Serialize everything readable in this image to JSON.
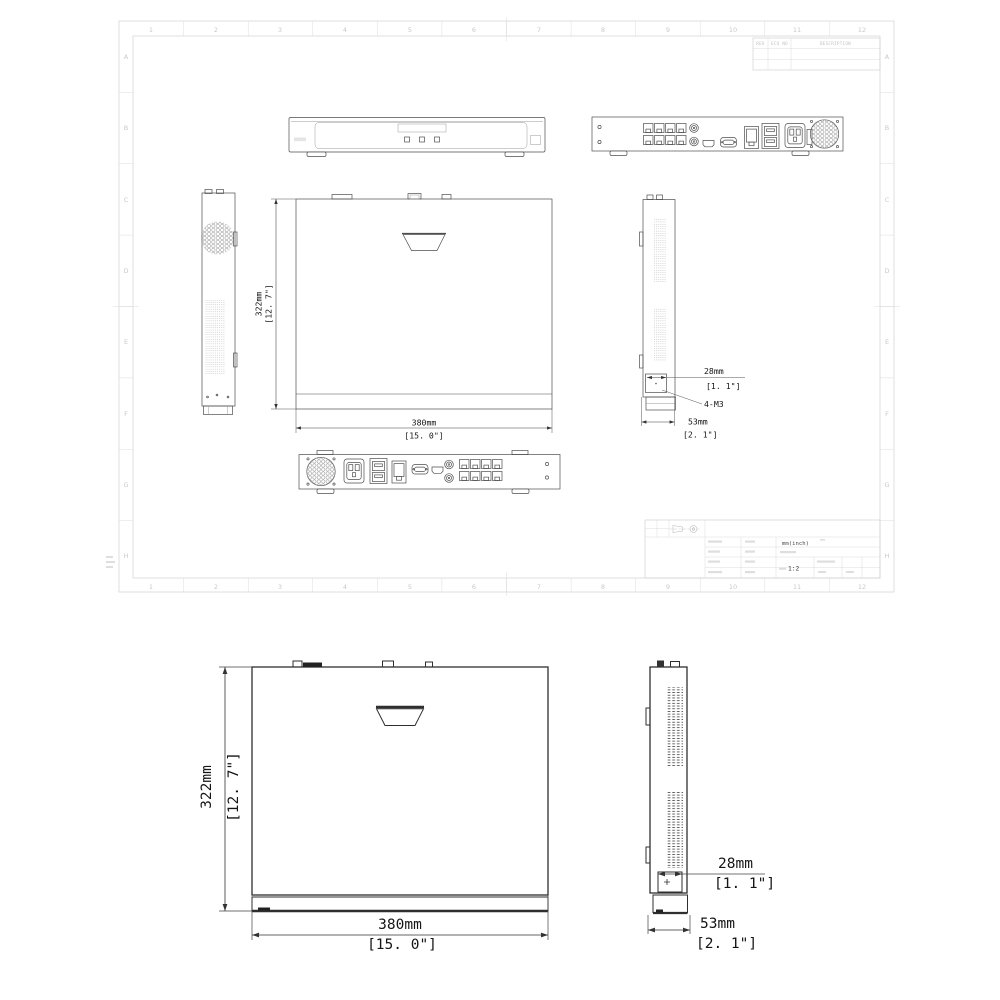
{
  "sheet": {
    "grid_numbers": [
      "1",
      "2",
      "3",
      "4",
      "5",
      "6",
      "7",
      "8",
      "9",
      "10",
      "11",
      "12"
    ],
    "grid_letters": [
      "A",
      "B",
      "C",
      "D",
      "E",
      "F",
      "G",
      "H"
    ],
    "revision_table": {
      "rev": "REV",
      "eco": "ECO NO",
      "description": "DESCRIPTION"
    },
    "title_block": {
      "units": "mm(inch)",
      "scale": "1:2"
    }
  },
  "dims": {
    "height_mm": "322mm",
    "height_in": "[12. 7\"]",
    "width_mm": "380mm",
    "width_in": "[15. 0\"]",
    "bracket_mm": "28mm",
    "bracket_in": "[1. 1\"]",
    "screw": "4-M3",
    "depth_mm": "53mm",
    "depth_in": "[2. 1\"]"
  }
}
